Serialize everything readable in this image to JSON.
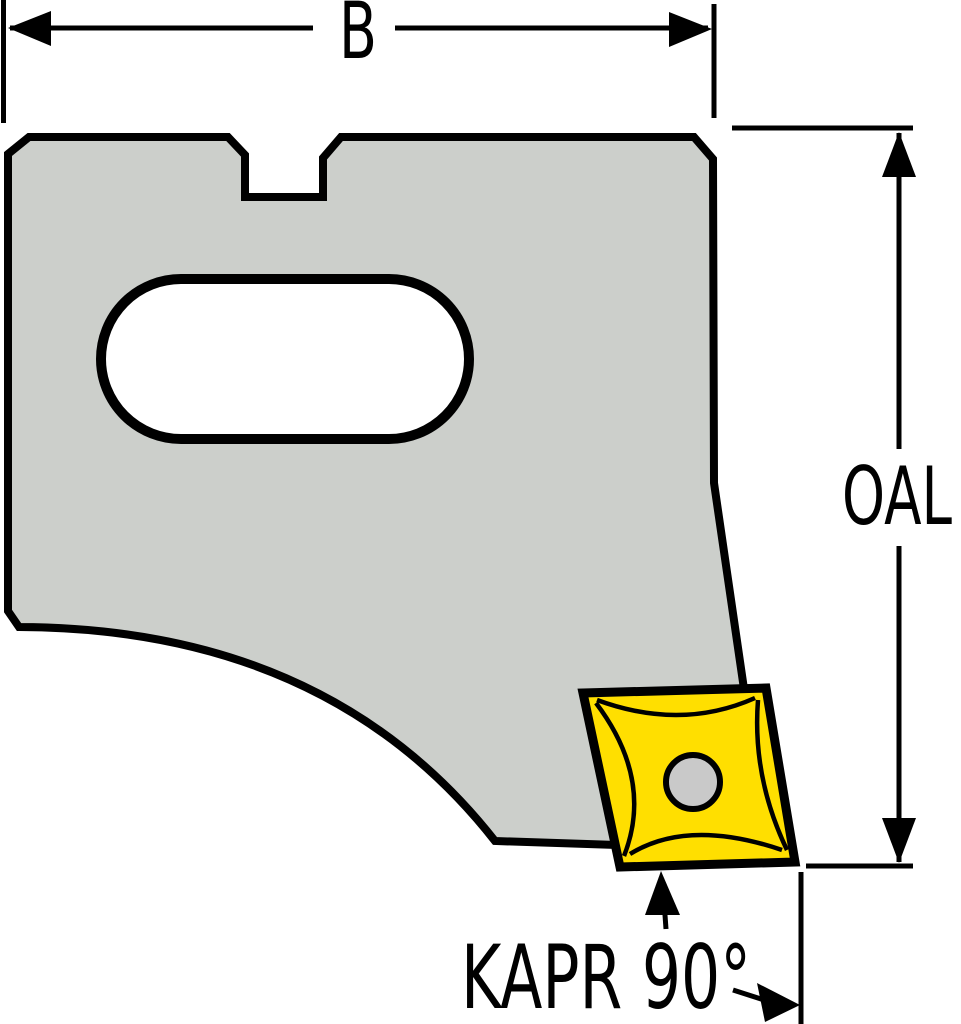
{
  "drawing": {
    "labels": {
      "width": "B",
      "overall_length": "OAL",
      "approach_angle": "KAPR 90°"
    },
    "colors": {
      "background": "#ffffff",
      "body_fill": "#cccfcb",
      "insert_fill": "#ffdf00",
      "hole_fill": "#c9c9c9",
      "line": "#000000"
    }
  }
}
